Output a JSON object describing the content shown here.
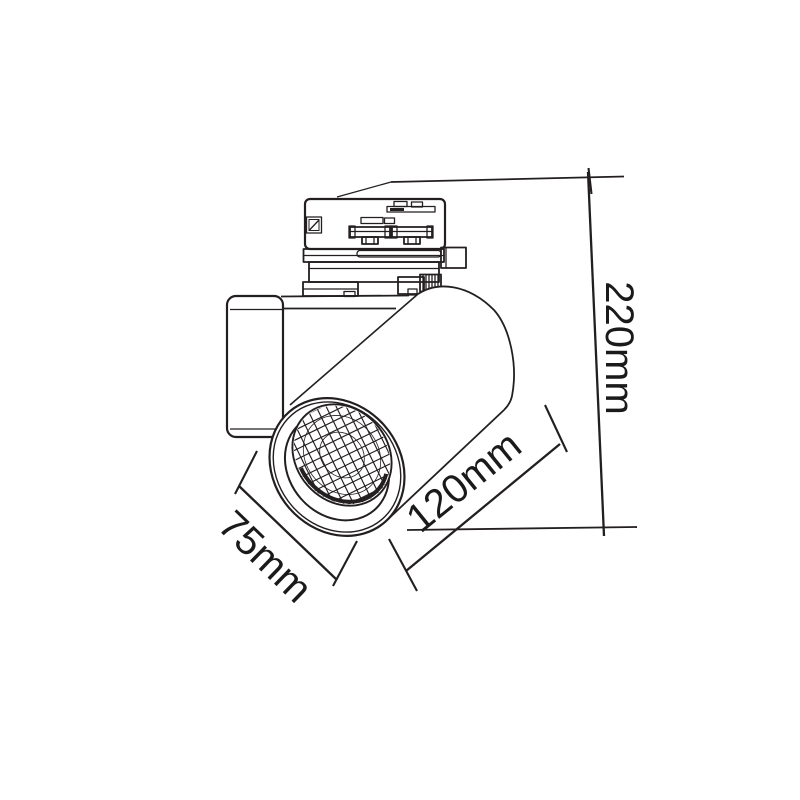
{
  "colors": {
    "background": "#ffffff",
    "line": "#231f20",
    "text": "#1a1a1a"
  },
  "diagram": {
    "type": "technical-dimension-drawing",
    "subject": "track-mounted spotlight luminaire with track adapter, mounting bracket and cylindrical lamp head",
    "dimensions": [
      {
        "name": "overall-height",
        "label": "220mm"
      },
      {
        "name": "body-length",
        "label": "120mm"
      },
      {
        "name": "front-diameter",
        "label": "75mm"
      }
    ]
  }
}
